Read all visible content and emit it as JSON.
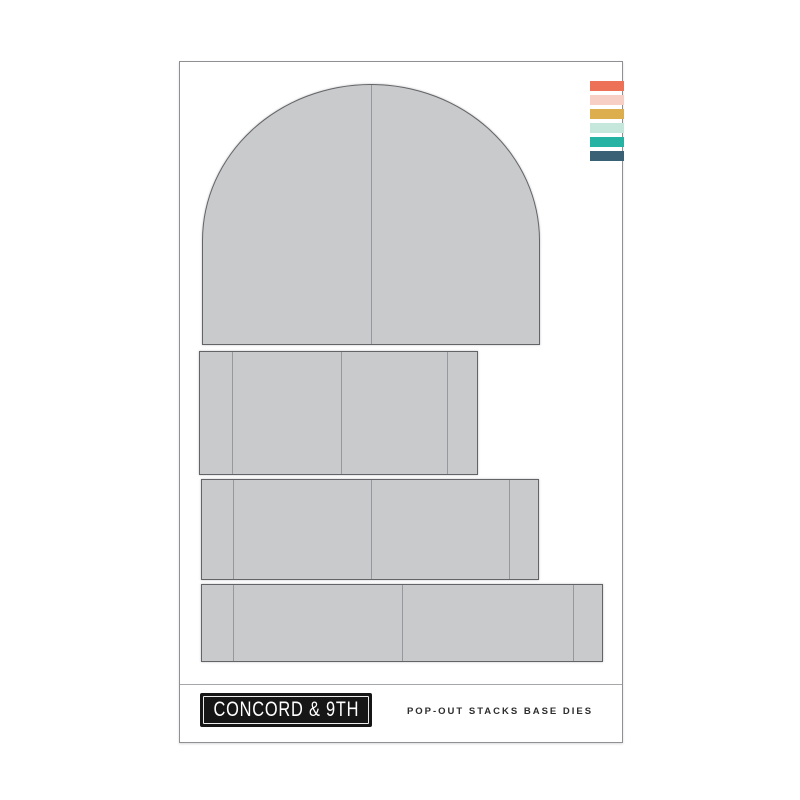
{
  "page": {
    "background": "#ffffff"
  },
  "card": {
    "background": "#ffffff",
    "border_color": "#8f9093"
  },
  "swatches": {
    "names": [
      "coral",
      "blush-pink",
      "mustard-gold",
      "mint",
      "teal",
      "slate-navy"
    ],
    "colors": [
      "#ec7156",
      "#f8cfc5",
      "#dcae4e",
      "#c5e7dc",
      "#27b3a4",
      "#3a6076"
    ]
  },
  "dies": {
    "count": 4,
    "fill_color": "#c9cacb",
    "outline_color": "#636468",
    "score_line_color": "#97989c",
    "shapes": [
      "arch-base",
      "panel-small",
      "panel-medium",
      "panel-large"
    ]
  },
  "footer": {
    "logo_text": "CONCORD & 9TH",
    "logo_bg": "#161616",
    "logo_text_color": "#ffffff",
    "product_title": "POP-OUT STACKS BASE DIES"
  }
}
